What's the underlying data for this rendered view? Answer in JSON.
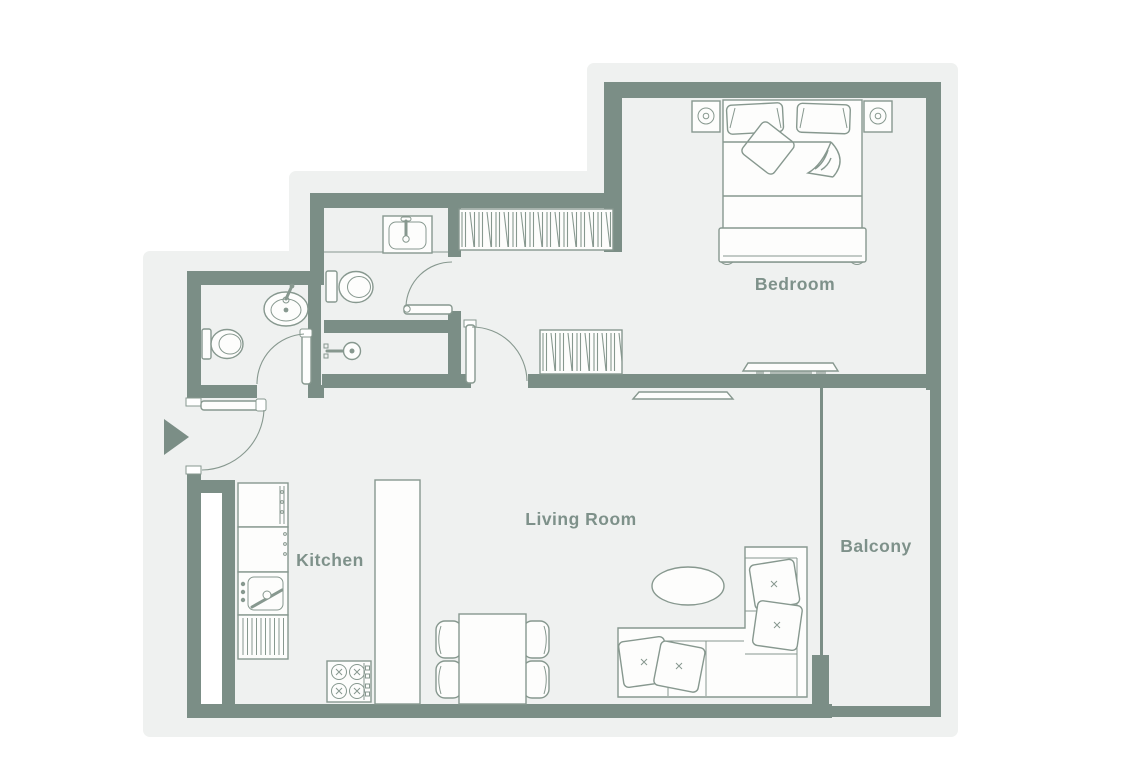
{
  "rooms": [
    {
      "id": "bedroom",
      "label": "Bedroom"
    },
    {
      "id": "living-room",
      "label": "Living Room"
    },
    {
      "id": "kitchen",
      "label": "Kitchen"
    },
    {
      "id": "balcony",
      "label": "Balcony"
    }
  ],
  "colors": {
    "page_background": "#ffffff",
    "plan_background": "#eff1f0",
    "wall": "#7b8e86",
    "furniture_line": "#87988f",
    "furniture_fill": "#fdfdfc",
    "room_label": "#7e918a",
    "entry_arrow": "#7b8e86"
  },
  "icons": [
    "entry-arrow-icon",
    "double-bed",
    "bed-pillow",
    "throw-pillow",
    "nightstand-lamp-icon",
    "wardrobe-hangers",
    "media-console",
    "sliding-window",
    "sectional-sofa",
    "sofa-cushion",
    "coffee-table",
    "dining-table",
    "dining-chair",
    "kitchen-sink",
    "stove-burners-icon",
    "dishwasher",
    "fridge",
    "kitchen-island",
    "wash-basin",
    "toilet",
    "shower-head-icon",
    "door-swing",
    "balcony-glazing"
  ]
}
